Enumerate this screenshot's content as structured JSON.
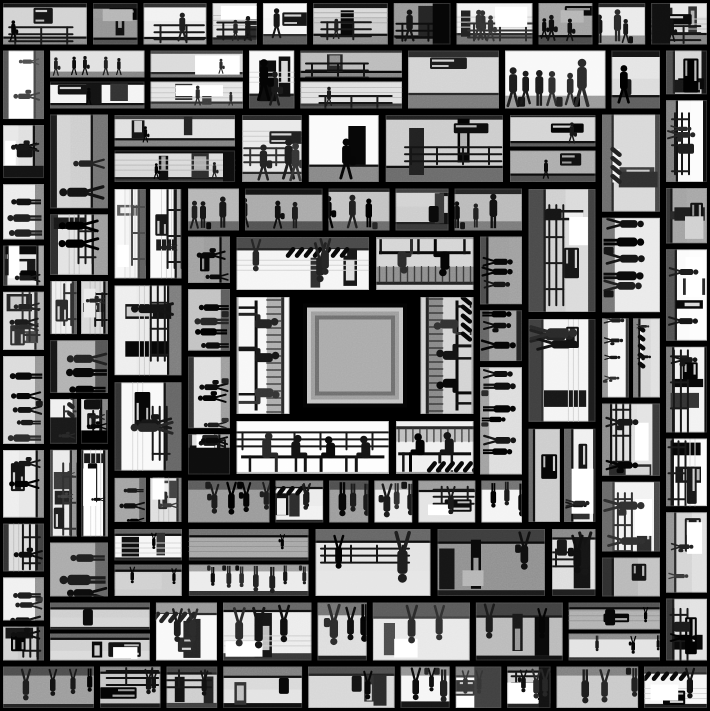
{
  "artwork": {
    "canvas": {
      "width": 710,
      "height": 711,
      "background": "#000000"
    },
    "seed": 1371,
    "palette": {
      "gutter_black": "#050505",
      "mullion_dark": "#0d0d0d",
      "figure_ink": "#121212",
      "wall_bright": "#fafafa",
      "bench_bg": "#efefef",
      "floor_mid": "#8a8a8a",
      "cross_white": "#f6f6f6",
      "frame_grays": [
        "#0a0a0a",
        "#bdbdbd",
        "#9a9a9a",
        "#6e6e6e",
        "#a6a6a6"
      ],
      "tile_frame_gray": "#6e6e6e"
    },
    "center": {
      "half": 52,
      "interior_inset": 16,
      "bench_fill": "#3c3c3c",
      "bench_highlight": "#6a6a6a",
      "figure_fill": "#1f1f1f"
    },
    "rings": [
      {
        "name": "bench-ring",
        "outer": 122,
        "inner": 62,
        "type": "bench",
        "floor": "outward",
        "tile_min": 95,
        "tile_max": 235,
        "gutter": 7,
        "sitter_spacing": [
          26,
          34
        ]
      },
      {
        "name": "crowd-ring",
        "outer": 170,
        "inner": 122,
        "type": "crowd",
        "floor": "inward",
        "tile_min": 44,
        "tile_max": 96,
        "gutter": 6,
        "stander_spacing": [
          15,
          24
        ]
      },
      {
        "name": "corridor-ring",
        "outer": 244,
        "inner": 170,
        "type": "station",
        "floor": "inward",
        "tile_min": 62,
        "tile_max": 132,
        "gutter": 7
      },
      {
        "name": "platform-ring",
        "outer": 308,
        "inner": 244,
        "type": "station",
        "floor": "inward",
        "tile_min": 50,
        "tile_max": 116,
        "gutter": 6
      },
      {
        "name": "outer-ring",
        "outer": 356,
        "inner": 308,
        "type": "station",
        "floor": "inward",
        "tile_min": 42,
        "tile_max": 100,
        "gutter": 6
      }
    ],
    "grain_opacity": 0.18
  }
}
